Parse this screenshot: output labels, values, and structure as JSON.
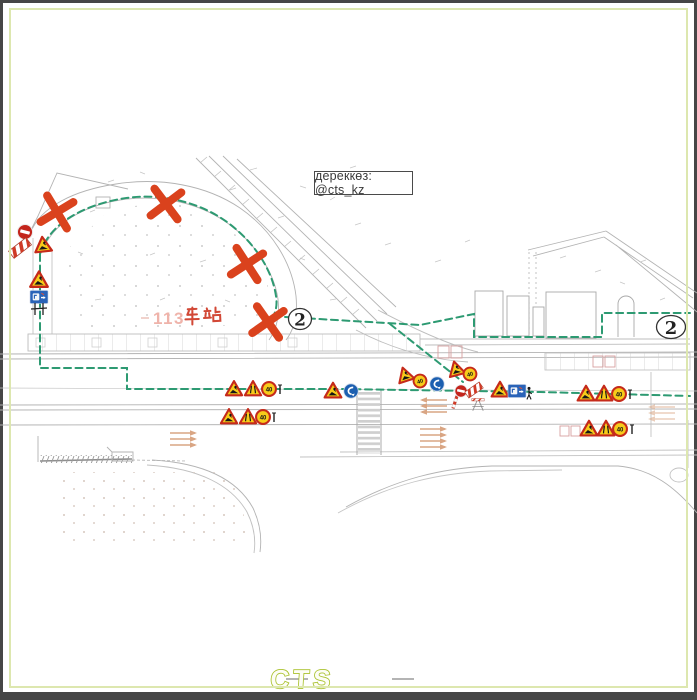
{
  "source_label": {
    "text": "дереккөз: @cts_kz"
  },
  "station_label": {
    "number": "113",
    "name": "车站"
  },
  "route_markers": {
    "left": "2",
    "right": "2"
  },
  "speed_limit": "40",
  "logo": {
    "text": "CTS"
  },
  "colors": {
    "closure_x": "#da421d",
    "detour_dashed": "#2d9a72",
    "sign_yellow": "#f7cb1a",
    "sign_red_border": "#c52a1a",
    "sign_blue": "#1c5fb0",
    "no_entry_red": "#c3251c",
    "station_number_pink": "#efb3aa",
    "station_name_red": "#d24836",
    "logo_green": "#aac22e",
    "inner_border_green": "#dde7af",
    "cad_gray": "#b3b3b3",
    "lane_arrow_tan": "#d9a583"
  },
  "sign_types": [
    "roadworks-warning-triangle",
    "road-narrows-triangle",
    "speed-limit-circle",
    "no-entry-circle",
    "detour-direction-circle",
    "barrier-chevron-board",
    "blue-info-sign",
    "flagman-figure",
    "closure-x-mark"
  ],
  "closure_marks_count": 4
}
